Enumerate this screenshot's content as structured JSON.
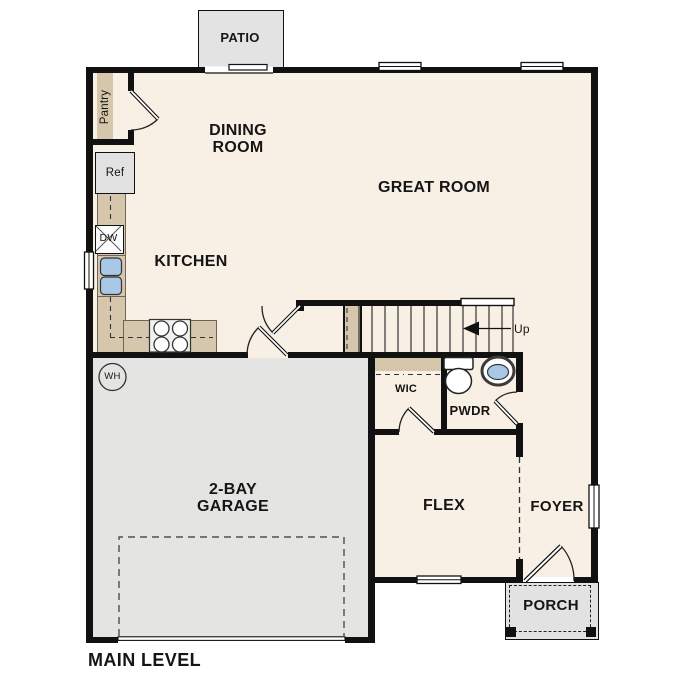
{
  "plan": {
    "title": "MAIN LEVEL",
    "rooms": {
      "patio": "PATIO",
      "dining_line1": "DINING",
      "dining_line2": "ROOM",
      "great_room": "GREAT ROOM",
      "kitchen": "KITCHEN",
      "garage_line1": "2-BAY",
      "garage_line2": "GARAGE",
      "flex": "FLEX",
      "foyer": "FOYER",
      "porch": "PORCH",
      "powder": "PWDR",
      "wic": "WIC",
      "pantry": "Pantry"
    },
    "fixtures": {
      "refrigerator": "Ref",
      "dishwasher": "DW",
      "water_heater": "WH"
    },
    "stairs": {
      "direction_label": "Up"
    },
    "colors": {
      "floor": "#f8f0e4",
      "garage_floor": "#e4e4e2",
      "patio": "#e3e3e3",
      "porch": "#e2e2e2",
      "cabinet_tan": "#d5c6ac",
      "wall": "#111111",
      "fixture_blue": "#a9c7e7"
    }
  }
}
